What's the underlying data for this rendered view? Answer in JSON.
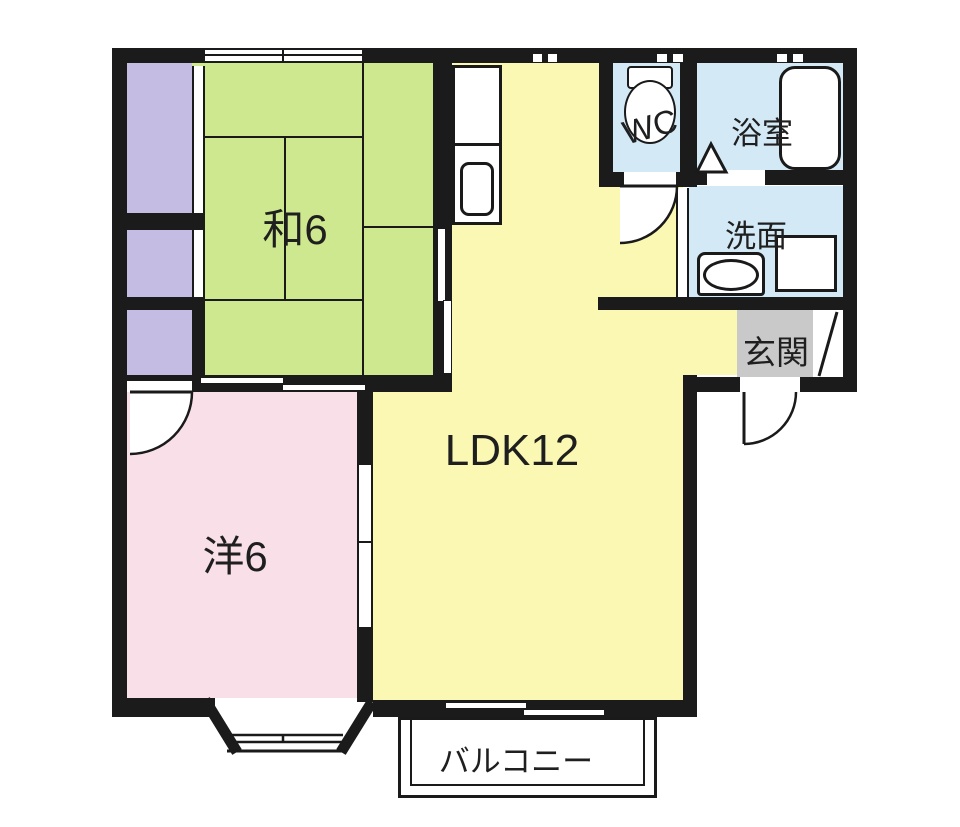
{
  "plan": {
    "type": "floorplan",
    "rooms": {
      "washitsu": {
        "label": "和6"
      },
      "youshitsu": {
        "label": "洋6"
      },
      "ldk": {
        "label": "LDK12"
      },
      "wc": {
        "label": "WC"
      },
      "bathroom": {
        "label": "浴室"
      },
      "washroom": {
        "label": "洗面"
      },
      "entrance": {
        "label": "玄関"
      },
      "balcony": {
        "label": "バルコニー"
      }
    }
  },
  "colors": {
    "wall": "#1b1b1b",
    "line": "#1a1a1a",
    "tatami": "#cde88f",
    "ldk": "#fbf8b4",
    "western": "#f9dfe8",
    "wet": "#d3eaf6",
    "closet": "#c4bce2",
    "egray": "#c9c9c9"
  }
}
